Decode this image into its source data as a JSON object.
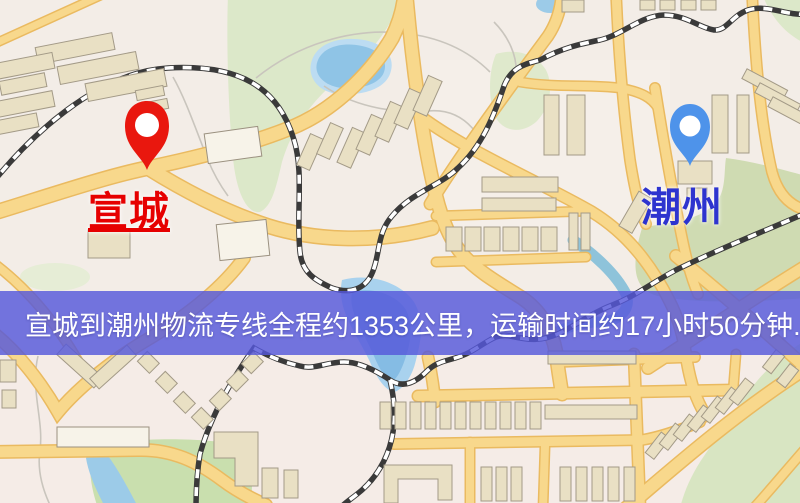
{
  "map": {
    "origin_marker": {
      "label": "宣城",
      "pin_color": "#e9170e",
      "label_color": "#e60000"
    },
    "destination_marker": {
      "label": "潮州",
      "pin_color": "#4e93ea",
      "label_color": "#2e34cf"
    },
    "info_banner": {
      "text": "宣城到潮州物流专线全程约1353公里，运输时间约17小时50分钟.",
      "background_color": "#5558da",
      "text_color": "#ffffff"
    },
    "route_summary": {
      "origin": "宣城",
      "destination": "潮州",
      "service_type": "物流专线",
      "distance": "约1353公里",
      "transit_time": "约17小时50分钟"
    }
  }
}
